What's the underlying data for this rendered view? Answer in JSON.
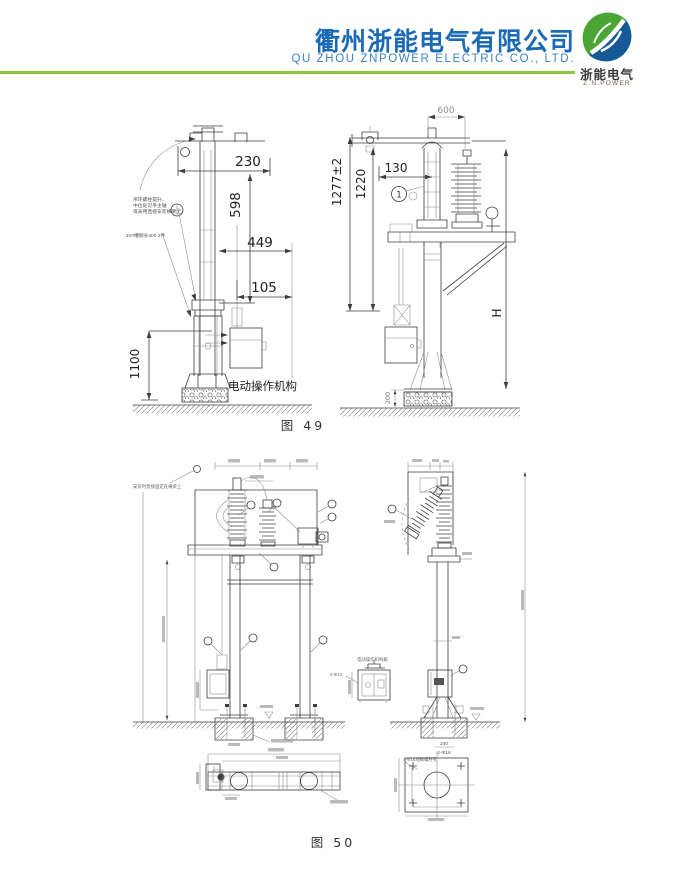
{
  "header": {
    "company_cn": "衢州浙能电气有限公司",
    "company_en": "QU ZHOU ZNPOWER ELECTRIC CO., LTD.",
    "logo": {
      "name_cn": "浙能电气",
      "name_en": "Z.N.POWER"
    },
    "colors": {
      "brand_blue": "#1a6ab5",
      "brand_green": "#8bc53f",
      "logo_green": "#4aa533",
      "logo_blue": "#155a96"
    }
  },
  "fig49": {
    "caption": "图 49",
    "left": {
      "dim_230": "230",
      "dim_598": "598",
      "dim_449": "449",
      "dim_105": "105",
      "dim_1100": "1100",
      "note_line1": "吊环螺栓提升，",
      "note_line2": "中位处可吊主轴",
      "note_line3": "或采用直接安装横梁上。",
      "note_channel": "10#槽钢长300 2件",
      "mech_label": "电动操作机构"
    },
    "right": {
      "dim_600": "600",
      "dim_1277": "1277±2",
      "dim_1220": "1220",
      "dim_130": "130",
      "dim_H": "H",
      "dim_200": "200",
      "balloon_1": "1"
    }
  },
  "fig50": {
    "caption": "图 50",
    "note_top_left": "安装时直接固定在横梁上",
    "mech_detail_label": "电动操作机构箱",
    "note_bolt": "4-Φ12",
    "plate_dim_top": "240",
    "plate_dim_bottom": "2-Φ18",
    "note_plate_holes": "4-Φ18地脚螺栓孔"
  }
}
